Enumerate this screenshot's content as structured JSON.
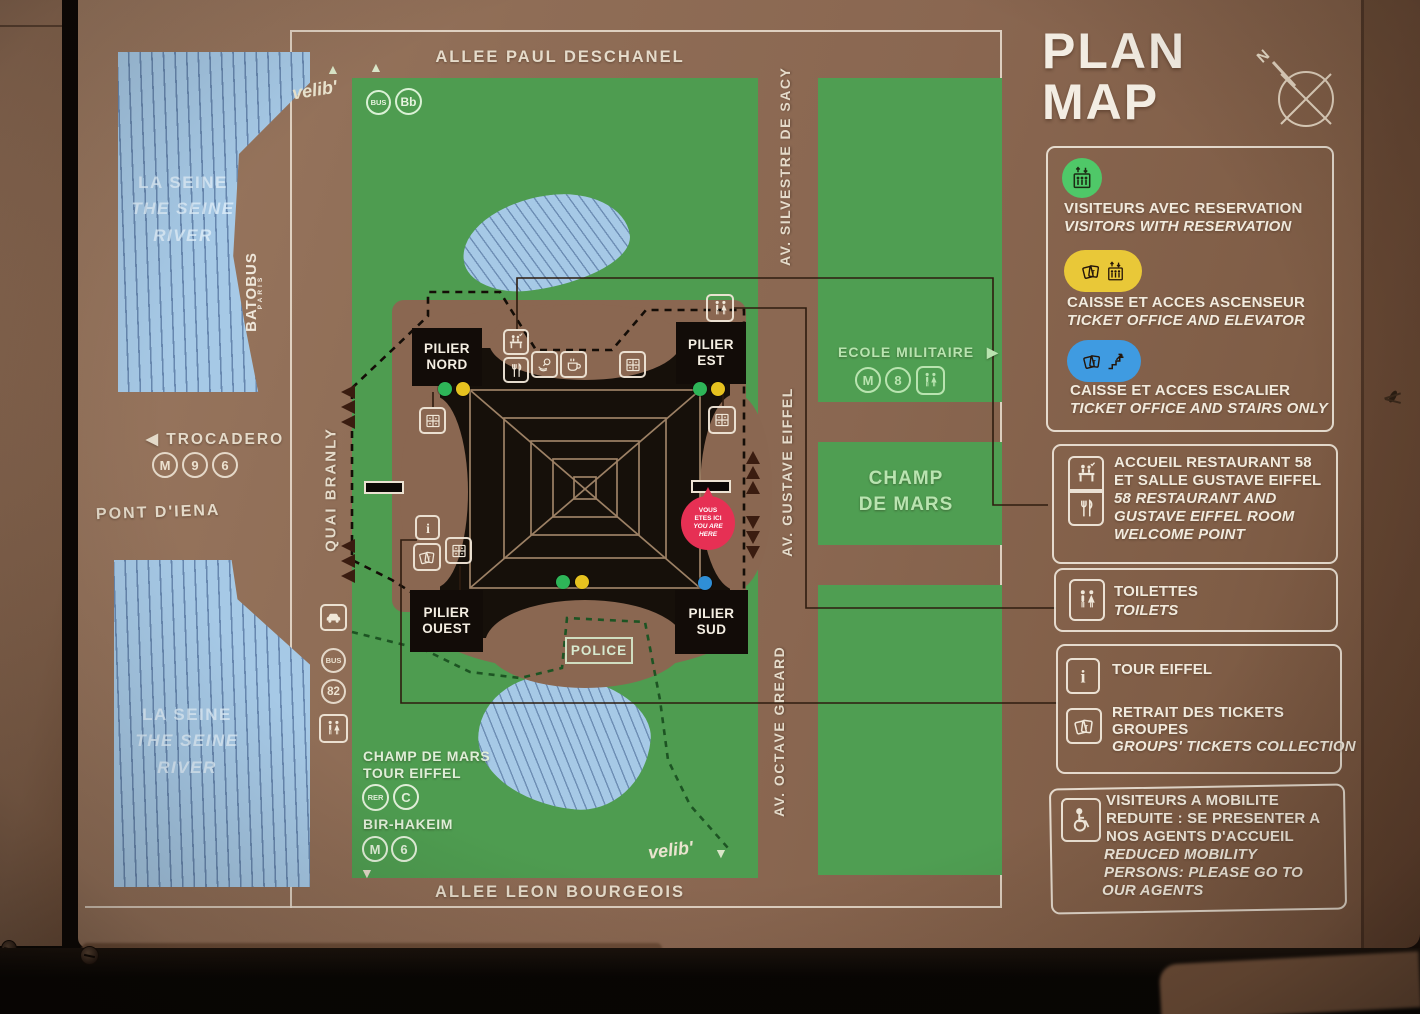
{
  "panel": {
    "title_line1": "PLAN",
    "title_line2": "MAP",
    "compass_north": "N"
  },
  "streets": {
    "top": "ALLEE PAUL DESCHANEL",
    "bottom": "ALLEE LEON BOURGEOIS",
    "west": "QUAI BRANLY",
    "east_top": "AV. SILVESTRE DE SACY",
    "east_mid": "AV. GUSTAVE EIFFEL",
    "east_bottom": "AV. OCTAVE GREARD",
    "pont": "PONT D'IENA"
  },
  "river": {
    "fr": "LA SEINE",
    "en_line1": "THE SEINE",
    "en_line2": "RIVER",
    "batobus": "BATOBUS",
    "batobus_sub": "PARIS"
  },
  "badges": {
    "metro": "M",
    "rer": "RER",
    "bus": "BUS",
    "balabus": "Bb",
    "line9": "9",
    "line6": "6",
    "line8": "8",
    "line_c": "C",
    "bus82": "82",
    "velib": "velib'"
  },
  "places": {
    "trocadero": "TROCADERO",
    "ecole_militaire": "ECOLE MILITAIRE",
    "champ_line1": "CHAMP",
    "champ_line2": "DE MARS",
    "police": "POLICE",
    "station_rer_line1": "CHAMP DE MARS",
    "station_rer_line2": "TOUR EIFFEL",
    "station_metro": "BIR-HAKEIM"
  },
  "piers": {
    "word": "PILIER",
    "nord": "NORD",
    "est": "EST",
    "ouest": "OUEST",
    "sud": "SUD"
  },
  "you_are_here": {
    "fr1": "VOUS",
    "fr2": "ETES ICI",
    "en1": "YOU ARE",
    "en2": "HERE"
  },
  "legend": {
    "reservation": {
      "icon": "elevator-icon",
      "color": "#4fc868",
      "fr": "VISITEURS AVEC RESERVATION",
      "en": "VISITORS WITH RESERVATION"
    },
    "elevator": {
      "icon": "tickets-elevator-icon",
      "color": "#e9c838",
      "fr": "CAISSE ET ACCES ASCENSEUR",
      "en": "TICKET OFFICE AND ELEVATOR"
    },
    "stairs": {
      "icon": "tickets-stairs-icon",
      "color": "#3f9be1",
      "fr": "CAISSE ET ACCES ESCALIER",
      "en": "TICKET OFFICE AND STAIRS ONLY"
    },
    "welcome": {
      "icon": "welcome-desk-restaurant-icon",
      "fr1": "ACCUEIL RESTAURANT 58",
      "fr2": "ET SALLE GUSTAVE EIFFEL",
      "en1": "58 RESTAURANT AND",
      "en2": "GUSTAVE EIFFEL ROOM",
      "en3": "WELCOME POINT"
    },
    "toilets": {
      "icon": "toilets-icon",
      "fr": "TOILETTES",
      "en": "TOILETS"
    },
    "tour_eiffel": {
      "icon": "info-icon",
      "fr": "TOUR EIFFEL"
    },
    "group_tickets": {
      "icon": "tickets-icon",
      "fr1": "RETRAIT DES TICKETS",
      "fr2": "GROUPES",
      "en": "GROUPS' TICKETS COLLECTION"
    },
    "mobility": {
      "icon": "wheelchair-icon",
      "fr1": "VISITEURS A MOBILITE",
      "fr2": "REDUITE : SE PRESENTER A",
      "fr3": "NOS AGENTS D'ACCUEIL",
      "en1": "REDUCED MOBILITY",
      "en2": "PERSONS: PLEASE GO TO",
      "en3": "OUR AGENTS"
    }
  },
  "colors": {
    "panel_brown": "#8d6b55",
    "park_green": "#4e9c50",
    "river_blue": "#a6c9e6",
    "dot_green": "#2eb558",
    "dot_yellow": "#e6c21f",
    "dot_blue": "#2f8fd6",
    "you_are_here_red": "#e63054",
    "badge_green": "#4fc868",
    "badge_yellow": "#e9c838",
    "badge_blue": "#3f9be1"
  }
}
